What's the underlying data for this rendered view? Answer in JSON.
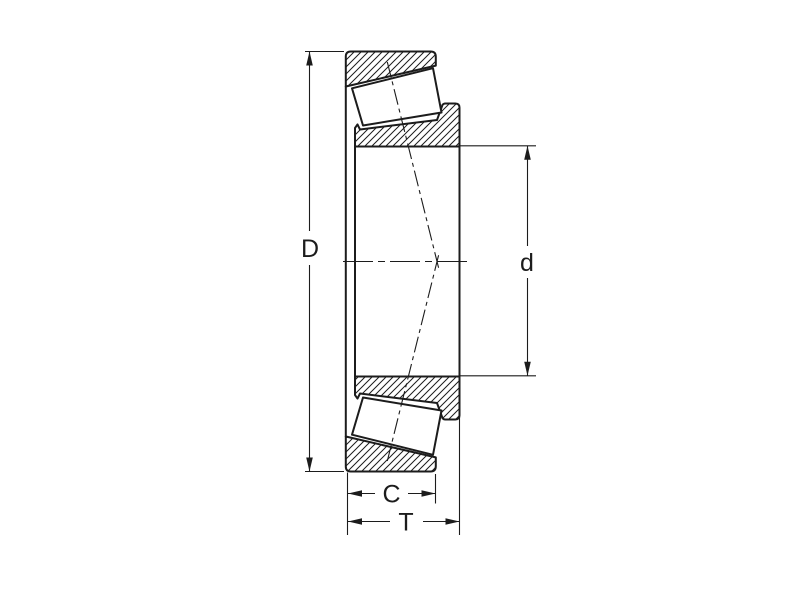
{
  "figure": {
    "dimension_labels": {
      "outer_diameter": "D",
      "bore_diameter": "d",
      "cup_width": "C",
      "total_width": "T"
    }
  }
}
